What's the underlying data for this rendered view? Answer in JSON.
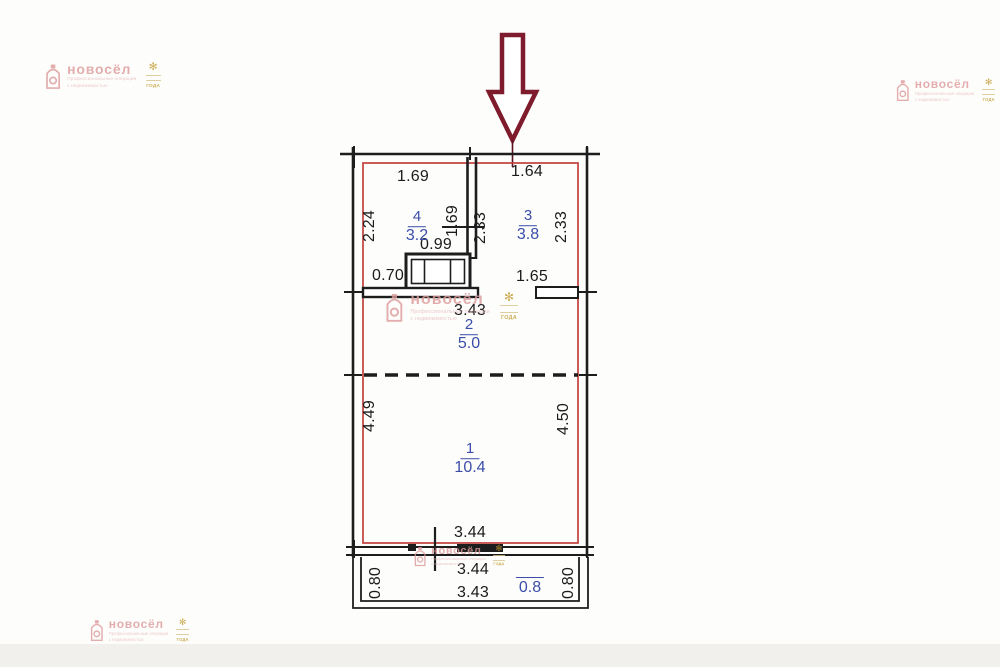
{
  "page": {
    "background_color": "#fdfdfc",
    "footer_strip_color": "#f2f0ed"
  },
  "plan": {
    "type": "floorplan",
    "entrance_arrow_color": "#7e1b2d",
    "outline_color": "#c0403d",
    "wall_color": "#1d1d1d",
    "room_label_color": "#3b4da8",
    "rooms": [
      {
        "number": "4",
        "area": "3.2"
      },
      {
        "number": "3",
        "area": "3.8"
      },
      {
        "number": "2",
        "area": "5.0"
      },
      {
        "number": "1",
        "area": "10.4"
      }
    ],
    "balcony_area": "0.8",
    "dims": {
      "h": [
        "1.69",
        "1.64",
        "0.99",
        "0.70",
        "1.65",
        "3.43",
        "3.44",
        "3.44",
        "3.43"
      ],
      "v": [
        "2.24",
        "1.69",
        "2.33",
        "2.33",
        "4.49",
        "4.50",
        "0.80",
        "0.80"
      ]
    }
  },
  "watermark": {
    "brand": "новосёл",
    "tagline_line1": "Профессиональные операции",
    "tagline_line2": "с недвижимостью",
    "badge_text": "ГОДА",
    "pink": "#dd9a9a",
    "gold": "#c0992c"
  }
}
